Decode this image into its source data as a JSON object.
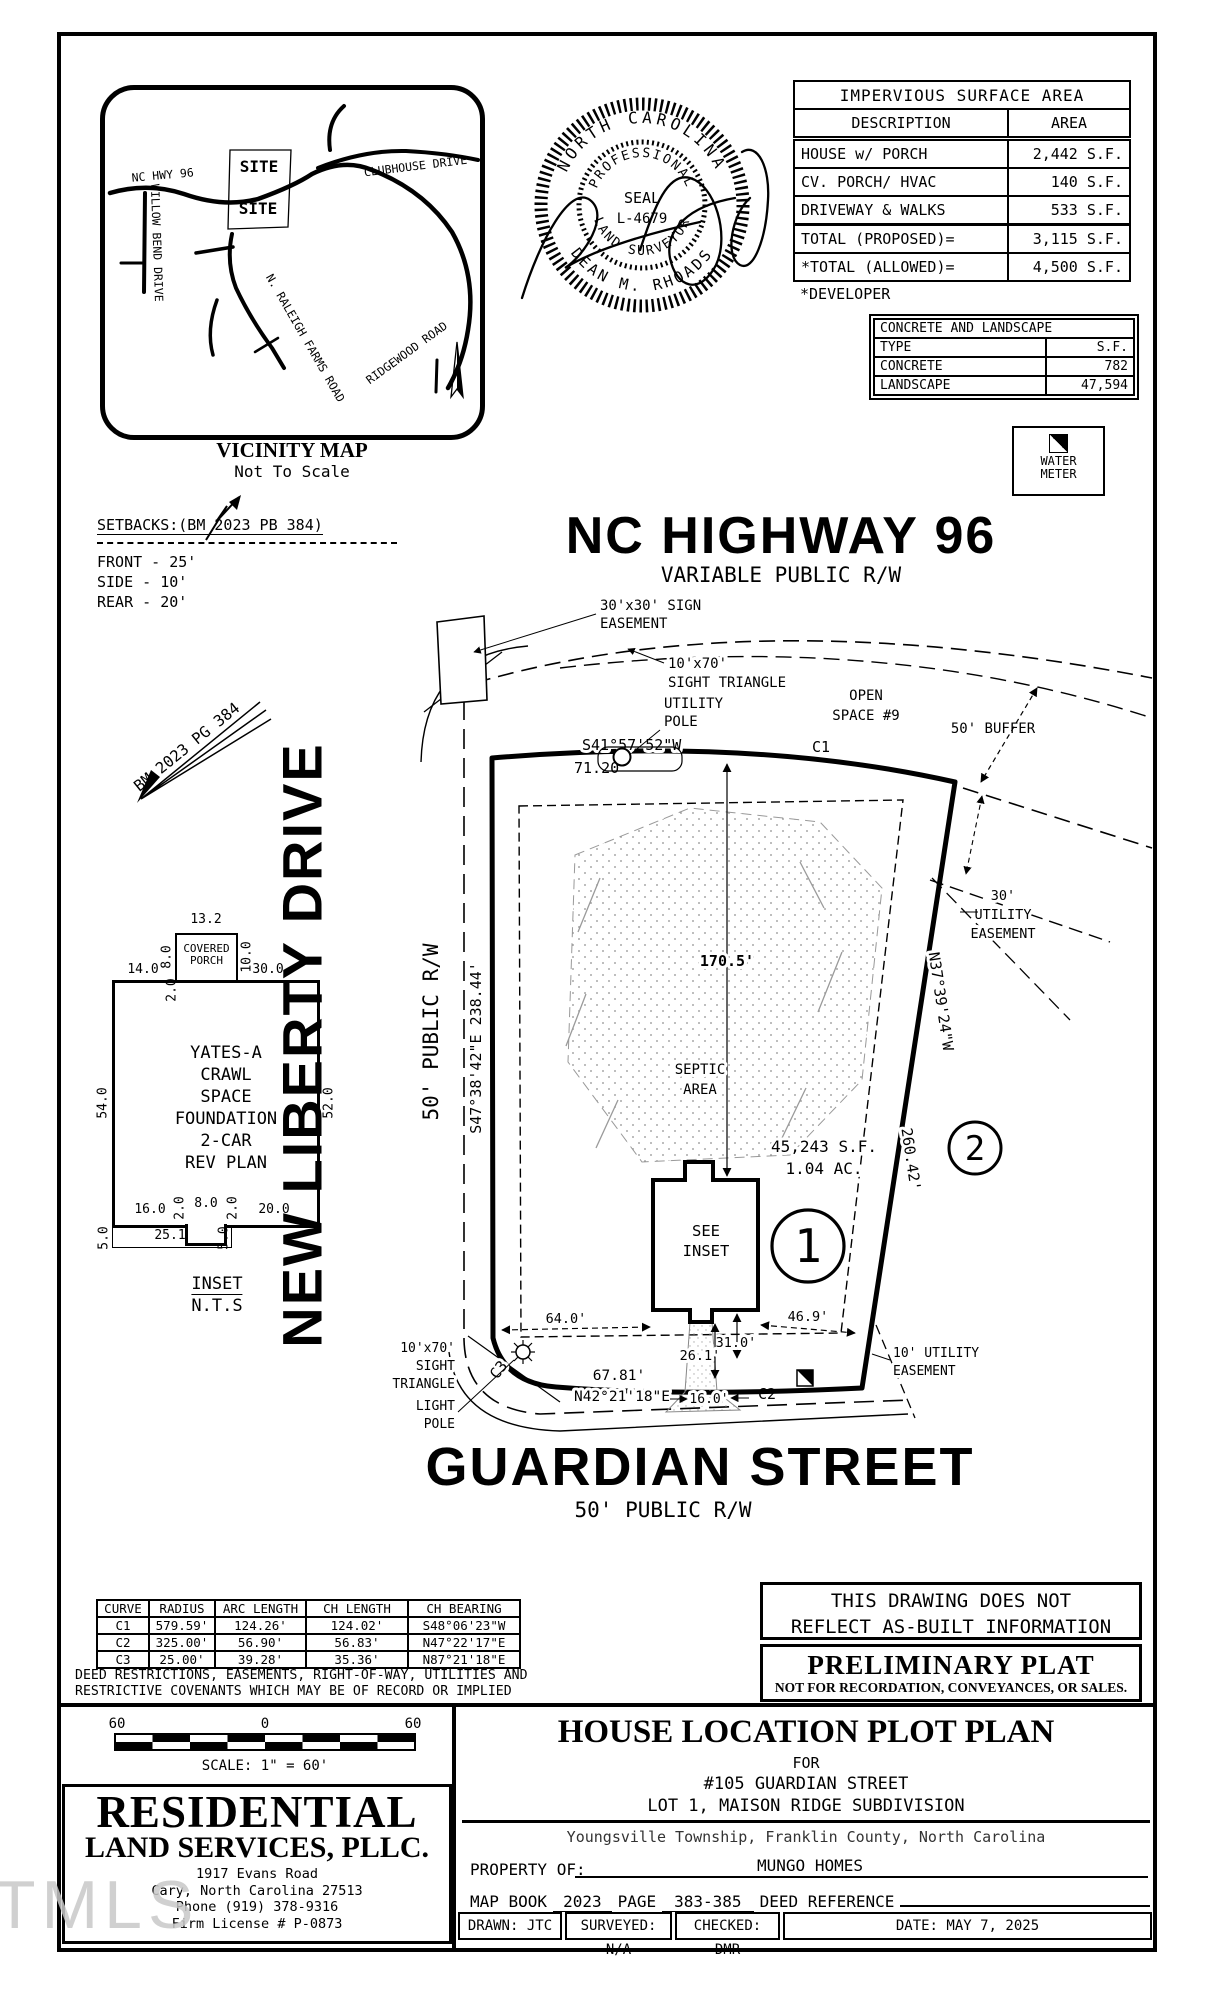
{
  "watermark": "TMLS",
  "vicinity": {
    "title": "VICINITY MAP",
    "subtitle": "Not To Scale",
    "site_top": "SITE",
    "site_bottom": "SITE",
    "roads": {
      "nc_hwy": "NC HWY 96",
      "willow": "WILLOW BEND DRIVE",
      "clubhouse": "CLUBHOUSE DRIVE",
      "raleigh": "N. RALEIGH FARMS ROAD",
      "ridgewood": "RIDGEWOOD ROAD"
    }
  },
  "seal": {
    "outer_top": "NORTH CAROLINA",
    "outer_bottom": "DEAN M. RHOADS",
    "inner_top": "PROFESSIONAL",
    "inner_bottom": "LAND SURVEYOR",
    "center1": "SEAL",
    "center2": "L-4679"
  },
  "impervious": {
    "title": "IMPERVIOUS SURFACE AREA",
    "col_desc": "DESCRIPTION",
    "col_area": "AREA",
    "rows": [
      {
        "desc": "HOUSE w/ PORCH",
        "area": "2,442 S.F."
      },
      {
        "desc": "CV. PORCH/ HVAC",
        "area": "140 S.F."
      },
      {
        "desc": "DRIVEWAY & WALKS",
        "area": "533 S.F."
      }
    ],
    "totals": [
      {
        "desc": "TOTAL (PROPOSED)=",
        "area": "3,115 S.F."
      },
      {
        "desc": "*TOTAL (ALLOWED)=",
        "area": "4,500 S.F."
      }
    ],
    "footnote": "*DEVELOPER"
  },
  "concrete": {
    "title": "CONCRETE AND LANDSCAPE",
    "col_type": "TYPE",
    "col_sf": "S.F.",
    "rows": [
      {
        "type": "CONCRETE",
        "sf": "782"
      },
      {
        "type": "LANDSCAPE",
        "sf": "47,594"
      }
    ]
  },
  "water_meter": {
    "line1": "WATER",
    "line2": "METER"
  },
  "setbacks": {
    "title": "SETBACKS:(BM 2023 PB 384)",
    "front": "FRONT - 25'",
    "side": "SIDE - 10'",
    "rear": "REAR - 20'"
  },
  "highway": {
    "name": "NC HIGHWAY 96",
    "rw": "VARIABLE PUBLIC R/W"
  },
  "guardian": {
    "name": "GUARDIAN STREET",
    "rw": "50' PUBLIC R/W"
  },
  "new_liberty": {
    "name": "NEW LIBERTY DRIVE",
    "rw": "50' PUBLIC R/W"
  },
  "plat": {
    "labels": {
      "sign1": "30'x30' SIGN",
      "sign2": "EASEMENT",
      "sight1": "10'x70'",
      "sight2": "SIGHT TRIANGLE",
      "upole1": "UTILITY",
      "upole2": "POLE",
      "open1": "OPEN",
      "open2": "SPACE #9",
      "buffer": "50' BUFFER",
      "bearing_n": "S41°57'52\"W",
      "dist_n": "71.20'",
      "c1": "C1",
      "c2": "C2",
      "c3": "C3",
      "east_bearing": "N37°39'24\"W",
      "east_dist": "260.42'",
      "west_label": "S47°38'42\"E  238.44'",
      "septic1": "SEPTIC",
      "septic2": "AREA",
      "dim170": "170.5'",
      "area1": "45,243 S.F.",
      "area2": "1.04 AC.",
      "see1": "SEE",
      "see2": "INSET",
      "lot1": "1",
      "lot2": "2",
      "d64": "64.0'",
      "d469": "46.9'",
      "d31": "31.0'",
      "d261": "26.1'",
      "d6781": "67.81'",
      "bearing_s": "N42°21'18\"E",
      "d16": "16.0'",
      "sightb1": "10'x70'",
      "sightb2": "SIGHT",
      "sightb3": "TRIANGLE",
      "lpole1": "LIGHT",
      "lpole2": "POLE",
      "ue10_1": "10' UTILITY",
      "ue10_2": "EASEMENT",
      "ue30_1": "30'",
      "ue30_2": "UTILITY",
      "ue30_3": "EASEMENT",
      "bm": "BM 2023 PG 384"
    }
  },
  "inset": {
    "porch1": "COVERED",
    "porch2": "PORCH",
    "name1": "YATES-A",
    "name2": "CRAWL",
    "name3": "SPACE",
    "name4": "FOUNDATION",
    "name5": "2-CAR",
    "name6": "REV PLAN",
    "caption1": "INSET",
    "caption2": "N.T.S",
    "dims": {
      "d132": "13.2",
      "d80t": "8.0",
      "d100": "10.0",
      "d140": "14.0",
      "d20a": "2.0",
      "d300": "30.0",
      "d540": "54.0",
      "d520": "52.0",
      "d160": "16.0",
      "d20b": "2.0",
      "d80b": "8.0",
      "d20c": "2.0",
      "d200": "20.0",
      "d50a": "5.0",
      "d251": "25.1",
      "d50b": "5.0"
    }
  },
  "curve_table": {
    "headers": [
      "CURVE",
      "RADIUS",
      "ARC LENGTH",
      "CH LENGTH",
      "CH BEARING"
    ],
    "rows": [
      [
        "C1",
        "579.59'",
        "124.26'",
        "124.02'",
        "S48°06'23\"W"
      ],
      [
        "C2",
        "325.00'",
        "56.90'",
        "56.83'",
        "N47°22'17\"E"
      ],
      [
        "C3",
        "25.00'",
        "39.28'",
        "35.36'",
        "N87°21'18\"E"
      ]
    ]
  },
  "notes": {
    "line1": "DEED RESTRICTIONS, EASEMENTS, RIGHT-OF-WAY, UTILITIES AND",
    "line2": "RESTRICTIVE COVENANTS WHICH MAY BE OF RECORD OR IMPLIED"
  },
  "scalebar": {
    "left": "60",
    "mid": "0",
    "right": "60",
    "caption": "SCALE: 1\" = 60'"
  },
  "firm": {
    "name1": "RESIDENTIAL",
    "name2": "LAND SERVICES, PLLC.",
    "addr1": "1917 Evans Road",
    "addr2": "Cary, North Carolina 27513",
    "addr3": "Phone (919) 378-9316",
    "addr4": "Firm License # P-0873"
  },
  "disclaimer": {
    "line1": "THIS DRAWING DOES NOT",
    "line2": "REFLECT AS-BUILT INFORMATION"
  },
  "preliminary": {
    "title": "PRELIMINARY PLAT",
    "subtitle": "NOT FOR RECORDATION, CONVEYANCES, OR SALES."
  },
  "titleblock": {
    "title": "HOUSE LOCATION PLOT PLAN",
    "for_label": "FOR",
    "address": "#105 GUARDIAN STREET",
    "lot": "LOT 1, MAISON RIDGE SUBDIVISION",
    "township": "Youngsville Township, Franklin County, North Carolina",
    "property_label": "PROPERTY OF:",
    "property": "MUNGO HOMES",
    "map_book_label": "MAP BOOK",
    "map_book": "2023",
    "page_label": "PAGE",
    "page": "383-385",
    "deed_label": "DEED REFERENCE",
    "drawn": "DRAWN: JTC",
    "surveyed": "SURVEYED: N/A",
    "checked": "CHECKED: DMR",
    "date": "DATE: MAY 7, 2025"
  }
}
